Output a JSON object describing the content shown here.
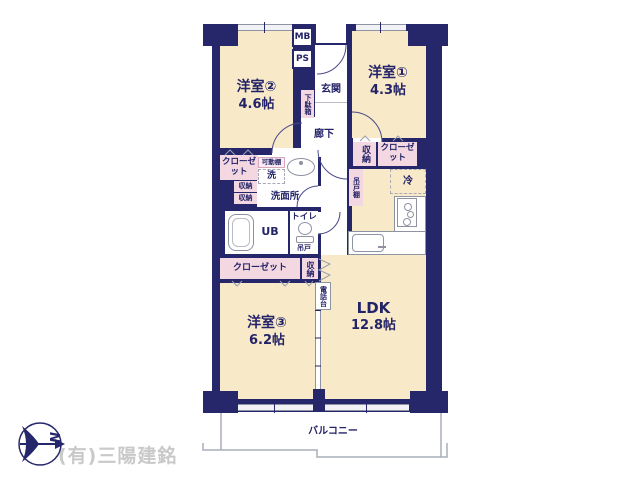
{
  "colors": {
    "wall": "#26266b",
    "room": "#f8e9c9",
    "storage": "#f3d7e1",
    "ink": "#232368",
    "line": "#9aa0ad",
    "credit": "#c9c9c9"
  },
  "rooms": {
    "western2": {
      "label": "洋室②",
      "area": "4.6帖"
    },
    "western1": {
      "label": "洋室①",
      "area": "4.3帖"
    },
    "western3": {
      "label": "洋室③",
      "area": "6.2帖"
    },
    "ldk": {
      "label": "LDK",
      "area": "12.8帖"
    }
  },
  "labels": {
    "mb": "MB",
    "ps": "PS",
    "genkan": "玄関",
    "getabako": "下駄箱",
    "rouka": "廊下",
    "closet_w2": "クローゼット",
    "kadoudana": "可動棚",
    "washer": "洗",
    "shuno_a": "収納",
    "shuno_b": "収納",
    "senmenjo": "洗面所",
    "shuno_right": "収納",
    "closet_w1": "クローゼット",
    "tsuridodana": "吊戸棚",
    "refrigerator": "冷",
    "ub": "UB",
    "toilet": "トイレ",
    "tsurido": "吊戸",
    "closet_w3": "クローゼット",
    "shuno_bottom": "収納",
    "denwadai": "電話台",
    "balcony": "バルコニー"
  },
  "compass": {
    "north": "N"
  },
  "credit": "(有)三陽建銘"
}
